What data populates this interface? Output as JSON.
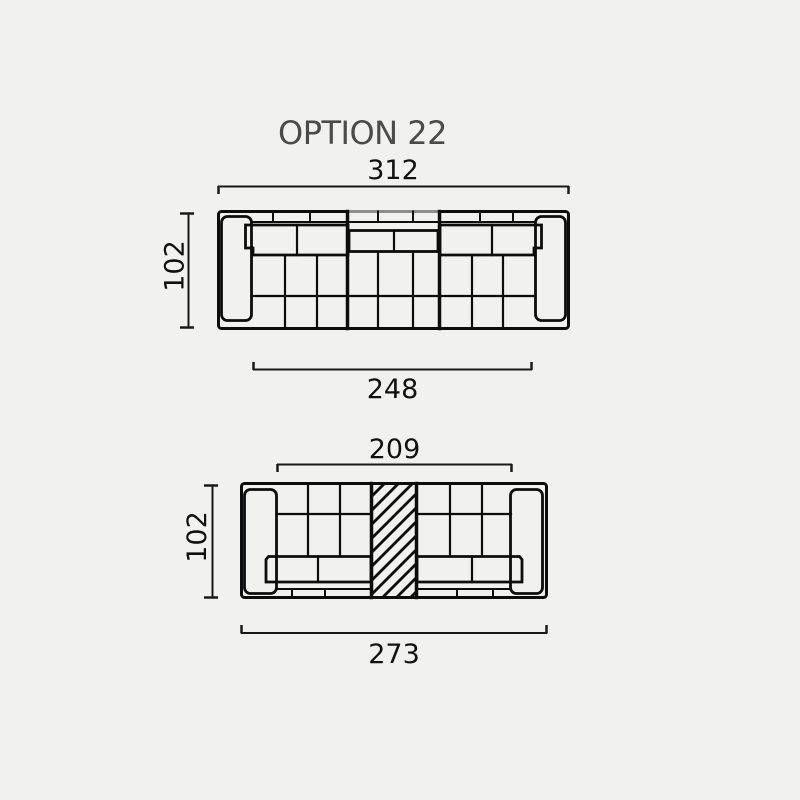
{
  "title": "OPTION 22",
  "colors": {
    "background": "#f1f1ef",
    "linework": "#0d0d0d",
    "dimension_lines": "#1a1a1a",
    "title_text": "#4a4a4a",
    "dimension_text": "#111111"
  },
  "diagrams": [
    {
      "name": "sofa-plan-upper",
      "orientation": "backrest-at-top",
      "dimensions": {
        "overall_width": "312",
        "depth": "102",
        "seat_width": "248"
      }
    },
    {
      "name": "sofa-plan-lower",
      "orientation": "backrest-at-bottom",
      "features": [
        "hatched-center-element"
      ],
      "dimensions": {
        "inner_width": "209",
        "depth": "102",
        "overall_width": "273"
      }
    }
  ]
}
